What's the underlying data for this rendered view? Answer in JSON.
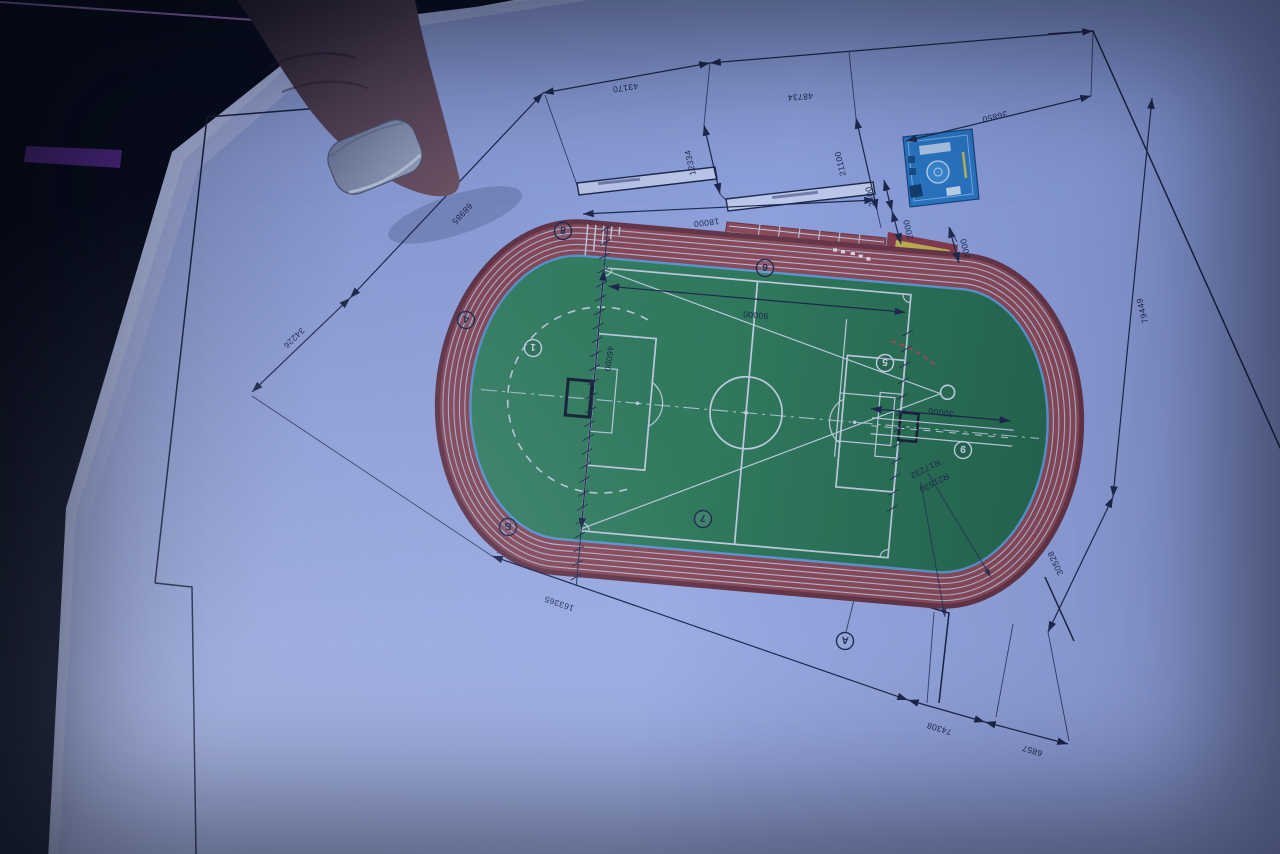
{
  "drawing": {
    "dims": [
      "43170",
      "48734",
      "12334",
      "21100",
      "2400",
      "2000",
      "2000",
      "36850",
      "18000",
      "68985",
      "34226",
      "46000",
      "90000",
      "30000",
      "79449",
      "30528",
      "163365",
      "74308",
      "6857",
      "R17232",
      "R21530"
    ],
    "markers": [
      "8",
      "6",
      "4",
      "1",
      "5",
      "9",
      "7",
      "Б",
      "А"
    ],
    "colors": {
      "paper": "#a5b4e8",
      "binder_purple": "#7a3fae",
      "track_red": "#94494f",
      "field_green": "#2f7a50",
      "curb_blue": "#5f9fd4",
      "sand_yellow": "#cbb945",
      "inset_blue": "#2a79c2",
      "ink": "#1c2440"
    }
  }
}
